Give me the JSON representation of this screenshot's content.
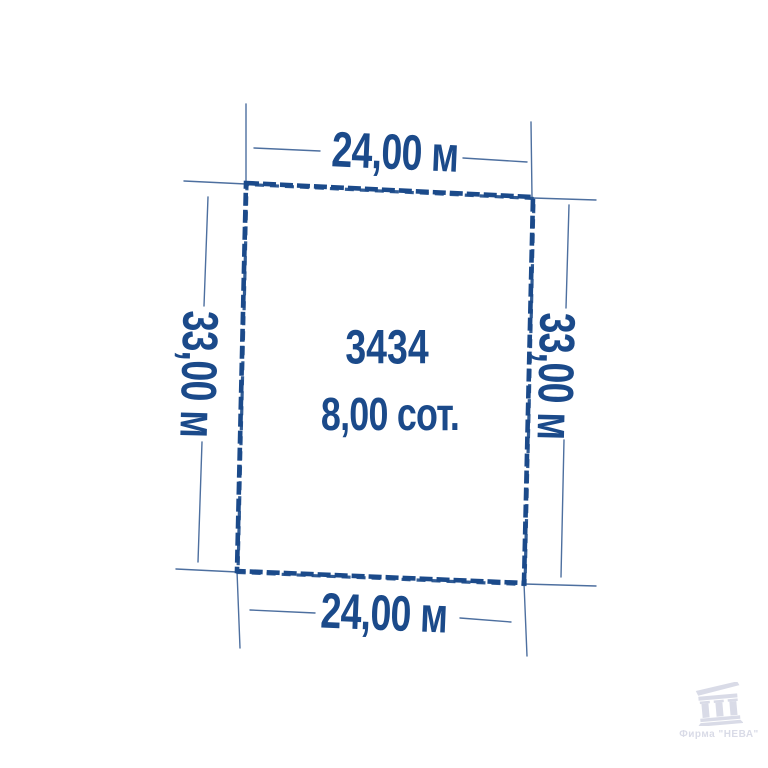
{
  "colors": {
    "navy": "#1b4a8a",
    "line": "#4d6f9f",
    "watermark": "#d9dbe7",
    "background": "#ffffff"
  },
  "plot": {
    "number": "3434",
    "area": "8,00 сот.",
    "width_top": "24,00 м",
    "width_bottom": "24,00 м",
    "side_left": "33,00 м",
    "side_right": "33,00 м"
  },
  "watermark": {
    "text": "Фирма \"НЕВА\""
  }
}
